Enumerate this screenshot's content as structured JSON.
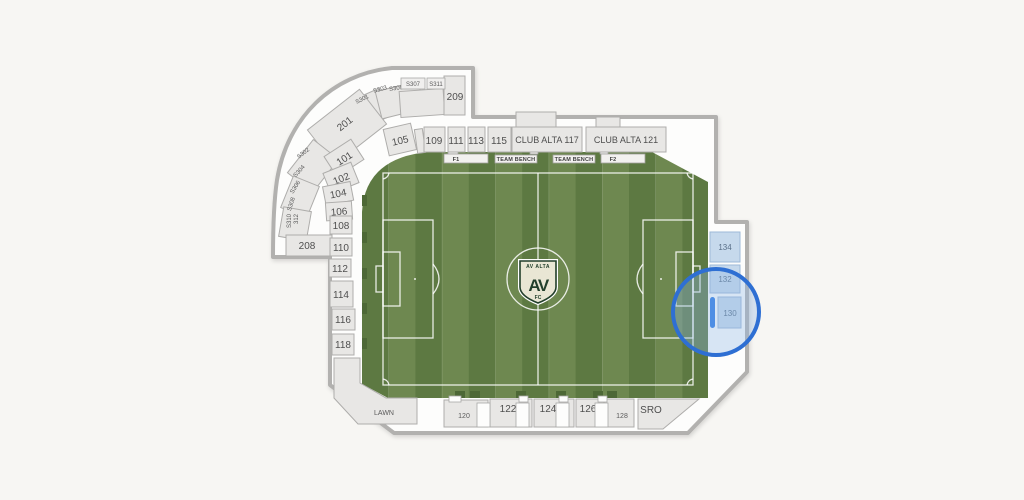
{
  "colors": {
    "background": "#f7f6f3",
    "wall": "#b2b1af",
    "bowl_fill": "#fdfdfc",
    "section_fill": "#e8e7e5",
    "section_border": "#aeadab",
    "stripe_dark": "#5d7942",
    "stripe_light": "#6e8850",
    "pitch_line": "#ffffff",
    "selected_fill": "#c6d9ec",
    "selected_border": "#9db9d7",
    "row_indicator_blue": "#2b79e3",
    "zoom_circle_blue": "#2e6fd3",
    "crest_cream": "#e9e6d4",
    "crest_green": "#223f2b"
  },
  "sections": {
    "s101": "101",
    "s102": "102",
    "s104": "104",
    "s105": "105",
    "s106": "106",
    "s108": "108",
    "s109": "109",
    "s110": "110",
    "s111": "111",
    "s112": "112",
    "s113": "113",
    "s114": "114",
    "s115": "115",
    "s116": "116",
    "s118": "118",
    "club117": "CLUB ALTA 117",
    "club121": "CLUB ALTA 121",
    "lawn": "LAWN",
    "s120": "120",
    "s122": "122",
    "s124": "124",
    "s126": "126",
    "s128": "128",
    "sro": "SRO",
    "s130": "130",
    "s132": "132",
    "s134": "134",
    "s201": "201",
    "s208": "208",
    "s209": "209",
    "su301": "S301",
    "su303": "S303",
    "su305": "S305",
    "su307": "S307",
    "su311": "S311",
    "su302": "S302",
    "su304": "S304",
    "su306": "S306",
    "su308": "S308",
    "su310": "S310",
    "su312": "312"
  },
  "field": {
    "f1": "F1",
    "f2": "F2",
    "team_bench_left": "TEAM BENCH",
    "team_bench_right": "TEAM BENCH",
    "crest": {
      "top": "AV ALTA",
      "monogram": "AV",
      "bottom": "FC"
    }
  }
}
